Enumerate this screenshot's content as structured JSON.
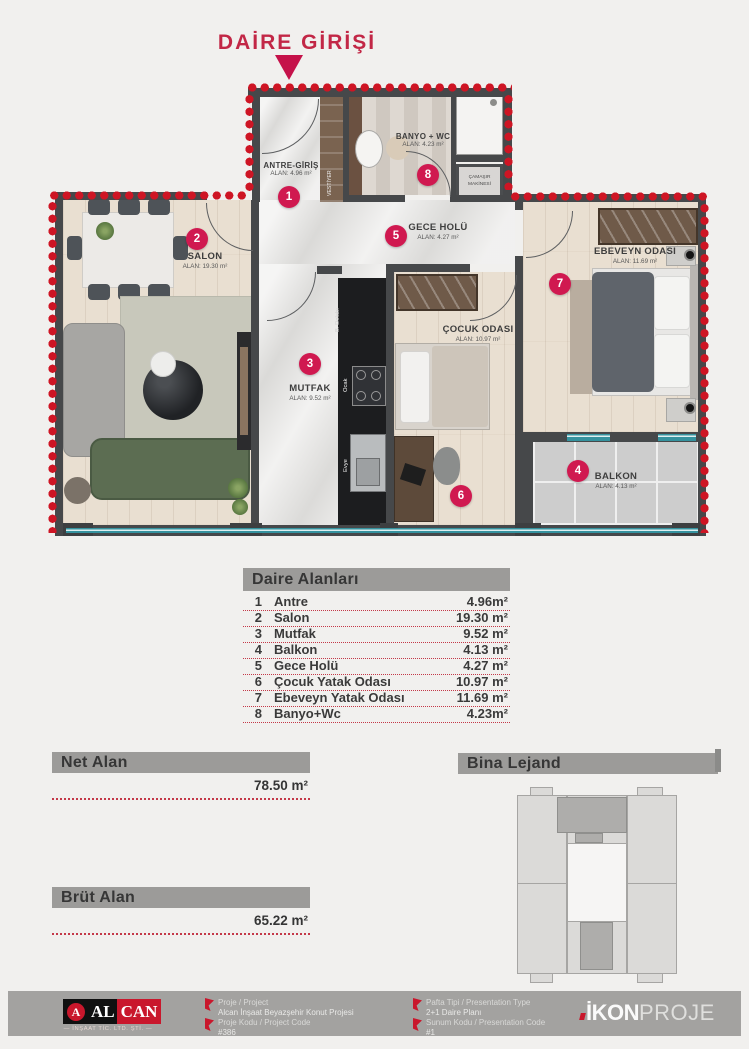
{
  "title": "DAİRE GİRİŞİ",
  "plan": {
    "badge_color": "#d01950",
    "rooms": [
      {
        "num": "1",
        "name": "ANTRE-GİRİŞ",
        "area": "ALAN: 4.96 m²"
      },
      {
        "num": "2",
        "name": "SALON",
        "area": "ALAN: 19.30 m²"
      },
      {
        "num": "3",
        "name": "MUTFAK",
        "area": "ALAN: 9.52 m²"
      },
      {
        "num": "4",
        "name": "BALKON",
        "area": "ALAN: 4.13 m²"
      },
      {
        "num": "5",
        "name": "GECE HOLÜ",
        "area": "ALAN: 4.27 m²"
      },
      {
        "num": "6",
        "name": "ÇOCUK ODASI",
        "area": "ALAN: 10.97 m²"
      },
      {
        "num": "7",
        "name": "EBEVEYN ODASI",
        "area": "ALAN: 11.69 m²"
      },
      {
        "num": "8",
        "name": "BANYO + WC",
        "area": "ALAN: 4.23 m²"
      }
    ],
    "fixtures": {
      "vestiyer": "VESTİYER",
      "camasir_line1": "ÇAMAŞIR",
      "camasir_line2": "MAKİNESİ",
      "ocak": "Ocak",
      "evye": "Evye",
      "b_dolabi": "B. Dolabı"
    }
  },
  "areas_table": {
    "header": "Daire Alanları",
    "rows": [
      {
        "num": "1",
        "name": "Antre",
        "value": "4.96m²"
      },
      {
        "num": "2",
        "name": "Salon",
        "value": "19.30 m²"
      },
      {
        "num": "3",
        "name": "Mutfak",
        "value": "9.52 m²"
      },
      {
        "num": "4",
        "name": "Balkon",
        "value": "4.13 m²"
      },
      {
        "num": "5",
        "name": "Gece Holü",
        "value": "4.27 m²"
      },
      {
        "num": "6",
        "name": "Çocuk Yatak Odası",
        "value": "10.97 m²"
      },
      {
        "num": "7",
        "name": "Ebeveyn Yatak Odası",
        "value": "11.69 m²"
      },
      {
        "num": "8",
        "name": "Banyo+Wc",
        "value": "4.23m²"
      }
    ]
  },
  "net_alan": {
    "label": "Net Alan",
    "value": "78.50 m²"
  },
  "brut_alan": {
    "label": "Brüt Alan",
    "value": "65.22 m²"
  },
  "bina_lejand": {
    "label": "Bina Lejand"
  },
  "footer": {
    "alcan": {
      "initial": "A",
      "name_black": "AL",
      "name_red": "CAN",
      "subtitle": "— İNŞAAT TİC. LTD. ŞTİ. —"
    },
    "entries": [
      {
        "label": "Proje / Project",
        "value": "Alcan İnşaat Beyazşehir Konut Projesi"
      },
      {
        "label": "Proje Kodu / Project Code",
        "value": "#386"
      },
      {
        "label": "Pafta Tipi / Presentation Type",
        "value": "2+1 Daire Planı"
      },
      {
        "label": "Sunum Kodu / Presentation Code",
        "value": "#1"
      }
    ],
    "ikonproje": {
      "bold": "İKON",
      "light": "PROJE"
    }
  }
}
